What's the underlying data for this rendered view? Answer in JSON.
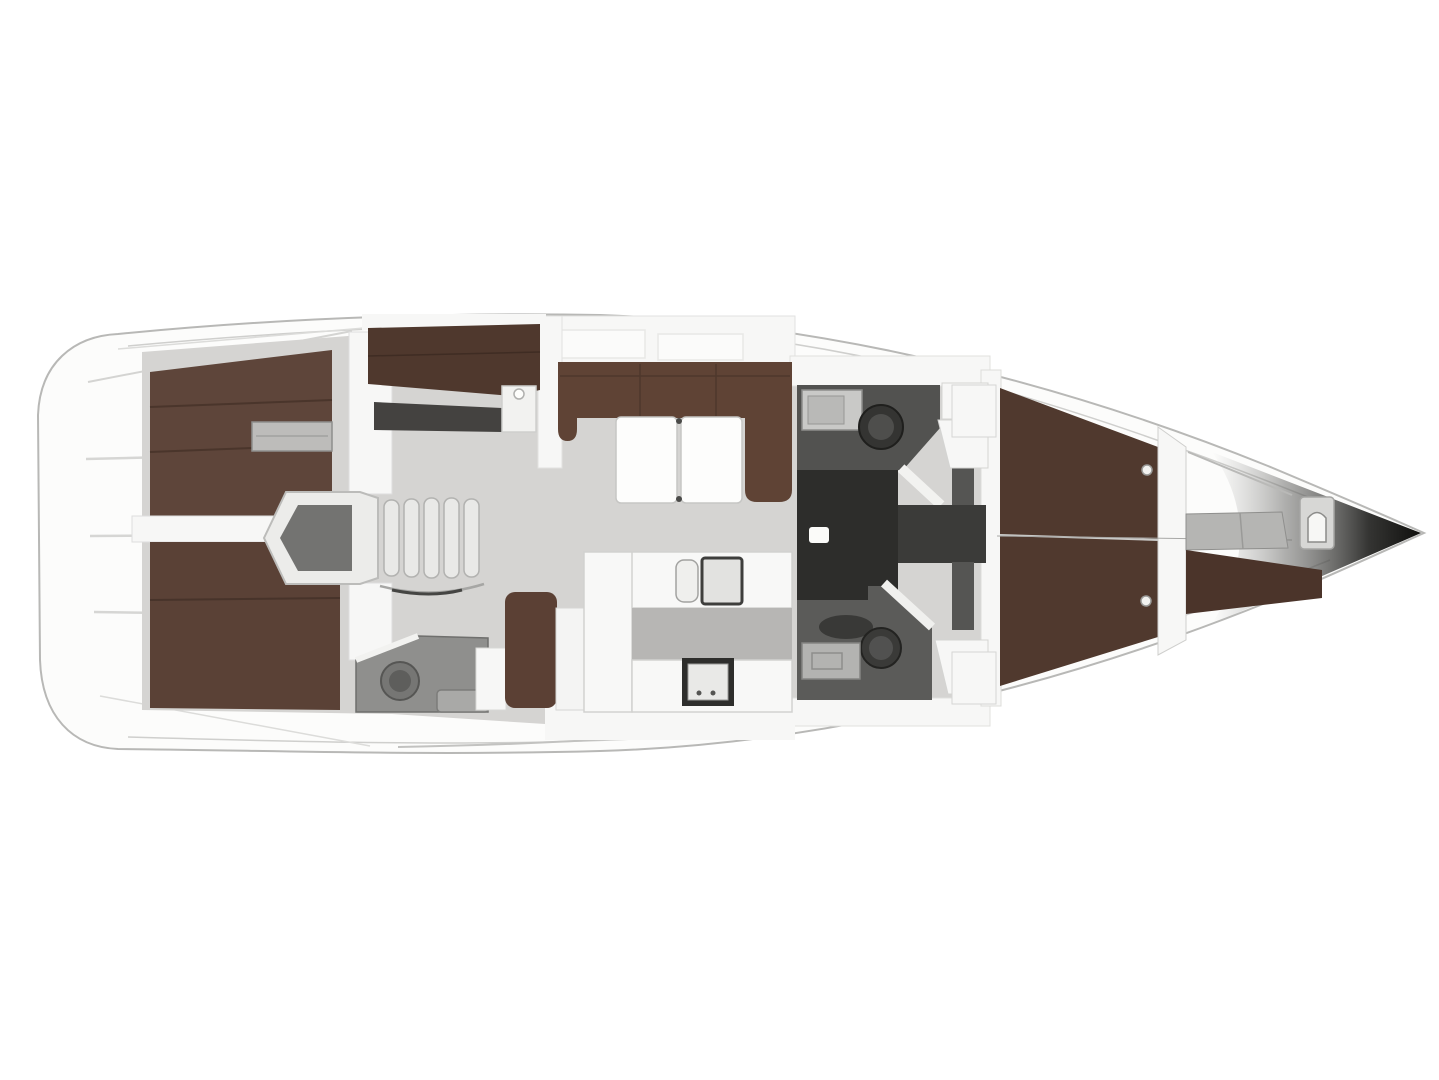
{
  "meta": {
    "type": "yacht-interior-floor-plan",
    "orientation": "bow-right"
  },
  "regions": {
    "hull": "hull and side deck",
    "swim_platform": "transom steps",
    "aft_cabin_upper": "aft double berth cabin (upper)",
    "aft_cabin_lower": "aft double berth cabin (lower)",
    "aft_head": "aft ensuite head with toilet and basin",
    "companionway": "companionway entry and stairs",
    "bunk_cabin": "bunk berth compartment",
    "salon": "salon U-settee with two-leaf folding table",
    "nav_seat": "seat and locker beside galley",
    "galley": "galley counters with twin sink and stove",
    "head_upper": "head with toilet and washstand (upper)",
    "head_lower": "head with toilet and washstand (lower)",
    "corridor": "dark passage to forward cabin",
    "forward_cabin": "forward cabin island double berth",
    "bow_compartment": "bow compartment with berth and small WC",
    "bow_tip": "shaded bow tip"
  },
  "colors": {
    "page_bg": "#ffffff",
    "hull": "#fcfcfb",
    "hull_stroke": "#b8b8b6",
    "deck_line": "#cfcfcd",
    "step_line": "#d6d6d4",
    "diag_line": "#d4d4d2",
    "floor": "#d5d4d2",
    "floor_dark": "#b7b6b4",
    "wall": "#f7f7f6",
    "wall_stroke": "#d8d8d6",
    "berth_aft": "#5e453a",
    "berth_aft_seam": "#4a352b",
    "berth_lower": "#5a4136",
    "berth_lower_seam": "#47332a",
    "sofa": "#5f4335",
    "sofa_seam": "#4e382c",
    "bunk": "#4f382d",
    "bunk_floor": "#444240",
    "berth_fwd": "#50392e",
    "berth_fwd_seam": "#cbcbc9",
    "berth_bow": "#4b342a",
    "nav_bench": "#5b4034",
    "table": "#fdfdfc",
    "table_stroke": "#c6c6c4",
    "hinge": "#4a4a48",
    "counter": "#f8f8f7",
    "counter_stroke": "#d2d2d0",
    "sink_small": "#efefed",
    "sink_large": "#e2e2e0",
    "sink_rim": "#3e3e3c",
    "stairs": "#e9e9e7",
    "stairs_stroke": "#b2b2b0",
    "companion_wall": "#ececea",
    "companion_inner": "#737371",
    "stove_frame": "#2e2e2c",
    "stove_inner": "#e9e9e7",
    "head_top_floor": "#525250",
    "head_bottom_floor": "#5b5b59",
    "head_small_floor": "#8f8f8d",
    "corridor": "#2d2d2b",
    "door_opening": "#3b3b39",
    "handle": "#fbfbf9",
    "toilet_dark": "#343432",
    "toilet_ring": "#4e4e4c",
    "toilet_small": "#767674",
    "toilet_small_ring": "#5e5e5c",
    "sink_unit": "#c9c9c7",
    "sink_unit_inner": "#b9b9b7",
    "sink_unit_dark": "#b3b3b1",
    "oval_tray": "#393937",
    "shelf": "#bdbcba",
    "wardrobe": "#555553",
    "bow_counter": "#b5b5b3",
    "wc_surround": "#d7d7d5",
    "wc_bowl": "#f7f7f5",
    "knob": "#f2f2f0",
    "centerline": "#a8a8a6",
    "cockpit_line": "#c2c2c0"
  }
}
